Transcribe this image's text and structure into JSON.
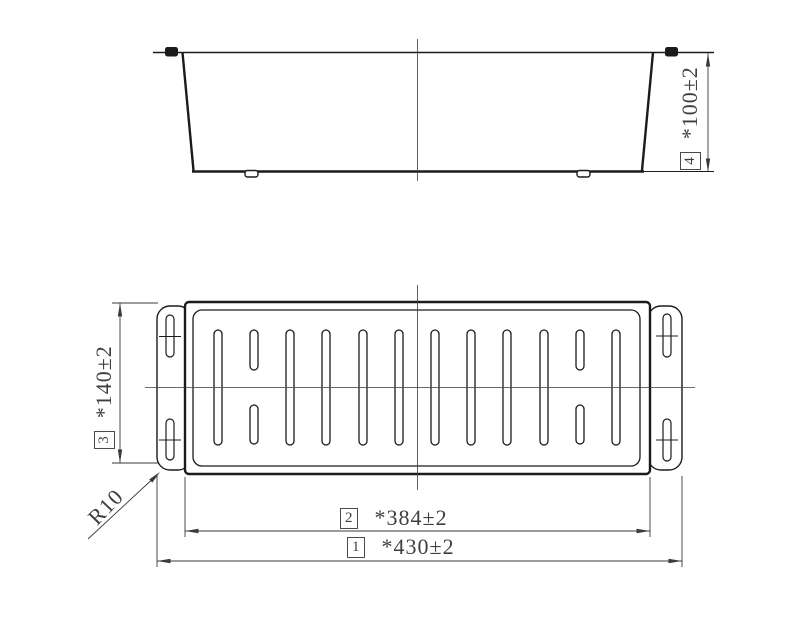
{
  "drawing": {
    "type": "engineering-drawing",
    "colors": {
      "line": "#1b1b1b",
      "thin_line": "#3a3a3a",
      "text": "#3f3f3f",
      "background": "#ffffff"
    },
    "views": {
      "side_view": {
        "description": "side elevation of basket with rim hooks and feet"
      },
      "plan_view": {
        "description": "bottom plan view with drain slots and end flanges",
        "slot_columns": 12
      }
    },
    "dimensions": {
      "d1": {
        "ref": "1",
        "value": "*430±2"
      },
      "d2": {
        "ref": "2",
        "value": "*384±2"
      },
      "d3": {
        "ref": "3",
        "value": "*140±2"
      },
      "d4": {
        "ref": "4",
        "value": "*100±2"
      }
    },
    "callouts": {
      "radius": "R10"
    }
  }
}
